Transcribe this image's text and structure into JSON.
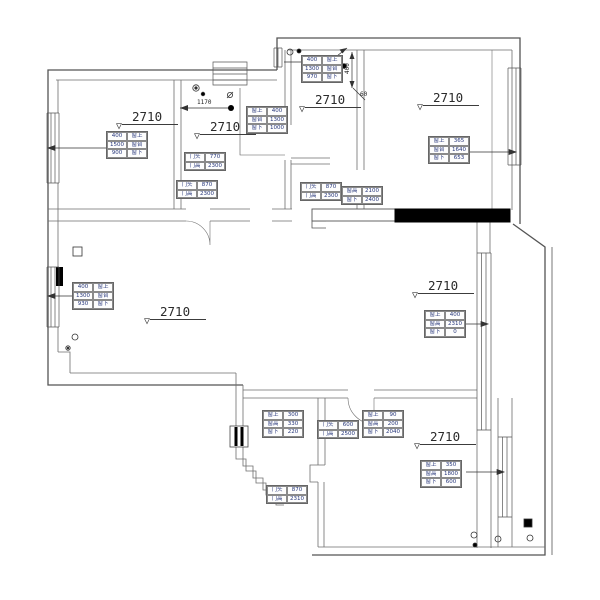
{
  "drawing": {
    "type": "residential floor plan (CAD ceiling-height survey)",
    "background": "#ffffff",
    "line_color": "#555555",
    "filled_wall_color": "#000000",
    "annotation_text_color": "#26367a"
  },
  "labels": {
    "bedroom_topleft": "2710",
    "kitchen": "2710",
    "entry": "2710",
    "bedroom_topright": "2710",
    "living": "2710",
    "dining": "2710",
    "bedroom_bottom": "2710"
  },
  "dims": {
    "w1170": "1170",
    "h400": "400",
    "a60": "60"
  },
  "tables": {
    "t_win_topleft": [
      [
        "400",
        "窗上"
      ],
      [
        "1500",
        "窗台"
      ],
      [
        "900",
        "窗下"
      ]
    ],
    "t_win_kitchen": [
      [
        "窗上",
        "400"
      ],
      [
        "窗台",
        "1300"
      ],
      [
        "窗下",
        "1000"
      ]
    ],
    "t_door_kitchen_a": [
      [
        "门头",
        "770"
      ],
      [
        "门高",
        "2300"
      ]
    ],
    "t_door_kitchen_b": [
      [
        "门头",
        "870"
      ],
      [
        "门高",
        "2300"
      ]
    ],
    "t_win_entry": [
      [
        "400",
        "窗上"
      ],
      [
        "1300",
        "窗台"
      ],
      [
        "970",
        "窗下"
      ]
    ],
    "t_win_topright": [
      [
        "窗上",
        "365"
      ],
      [
        "窗台",
        "1640"
      ],
      [
        "窗下",
        "653"
      ]
    ],
    "t_win_living_left": [
      [
        "400",
        "窗上"
      ],
      [
        "1300",
        "窗台"
      ],
      [
        "930",
        "窗下"
      ]
    ],
    "t_win_living_right": [
      [
        "窗上",
        "400"
      ],
      [
        "窗高",
        "2310"
      ],
      [
        "窗下",
        "0"
      ]
    ],
    "t_door_hall_a": [
      [
        "门头",
        "870"
      ],
      [
        "门高",
        "2300"
      ]
    ],
    "t_door_hall_b": [
      [
        "窗高",
        "2100"
      ],
      [
        "窗下",
        "2400"
      ]
    ],
    "t_cab_bottom": [
      [
        "窗上",
        "300"
      ],
      [
        "窗高",
        "330"
      ],
      [
        "窗下",
        "220"
      ]
    ],
    "t_door_bottom": [
      [
        "门头",
        "600"
      ],
      [
        "门高",
        "2500"
      ]
    ],
    "t_win_bottom_mid": [
      [
        "窗上",
        "90"
      ],
      [
        "窗高",
        "200"
      ],
      [
        "窗下",
        "2040"
      ]
    ],
    "t_win_bottomright": [
      [
        "窗上",
        "350"
      ],
      [
        "窗高",
        "1800"
      ],
      [
        "窗下",
        "600"
      ]
    ],
    "t_door_bath": [
      [
        "门头",
        "870"
      ],
      [
        "门高",
        "2310"
      ]
    ]
  }
}
